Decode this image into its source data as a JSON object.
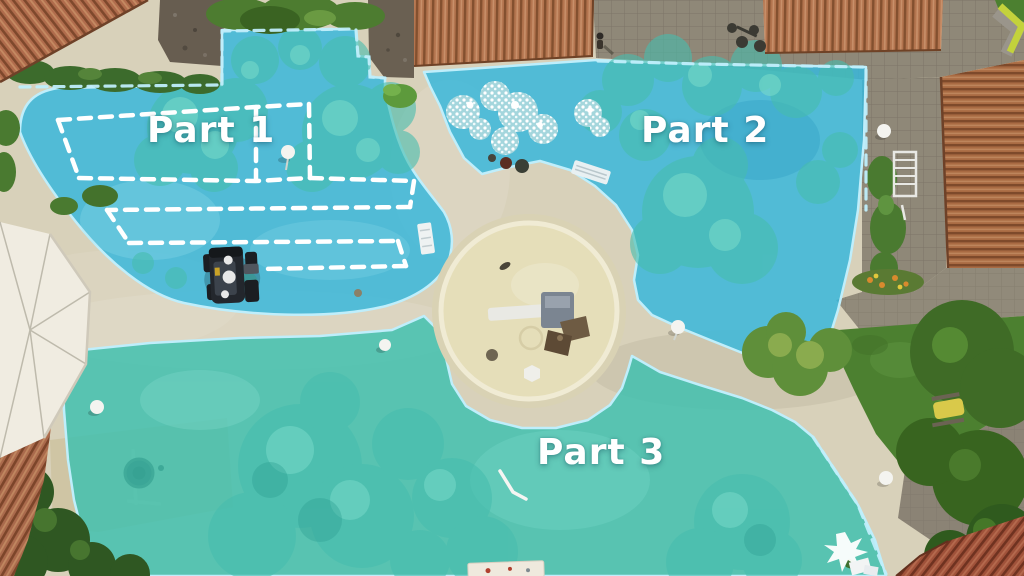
{
  "scene": {
    "part1_label": "Part 1",
    "part2_label": "Part 2",
    "part3_label": "Part 3"
  },
  "colors": {
    "base-sand": "#d8d1ba",
    "sand-circle": "#e5deb9",
    "overlay-blue": "#39b7da",
    "overlay-blue-deep": "#2aa9cf",
    "overlay-teal": "#3cbfae",
    "overlay-border": "#bfeefb",
    "plan-white": "#ffffff",
    "pavement": "#8f8878",
    "lawn-green": "#4c8030",
    "roof-terracotta": "#b3744e",
    "roof-dark": "#83502f",
    "roof-light": "#c8906a",
    "roof-red": "#a0523a",
    "tree-teal": "#47bdae",
    "tree-teal-light": "#7bdccb",
    "hedge-green": "#3c6b2c",
    "label-white": "#ffffff"
  }
}
